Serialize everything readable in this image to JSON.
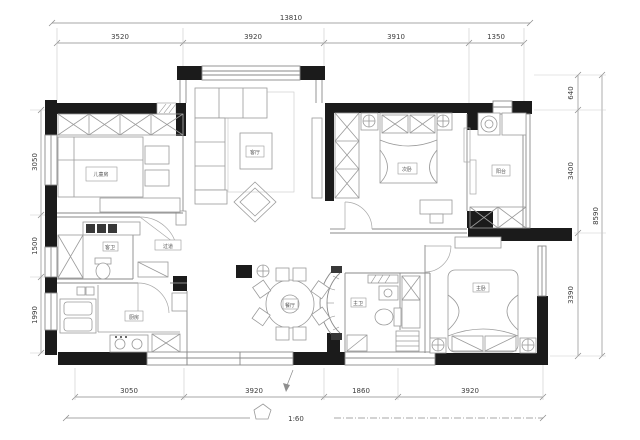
{
  "plan": {
    "scale_text": "1:60",
    "dims": {
      "top_total": "13810",
      "top": [
        "3520",
        "3920",
        "3910",
        "1350"
      ],
      "left": [
        "3050",
        "1500",
        "1990"
      ],
      "right_total": "8590",
      "right": [
        "640",
        "3400",
        "3390"
      ],
      "bottom": [
        "3050",
        "3920",
        "1860",
        "3920"
      ]
    },
    "rooms": {
      "study": "儿童房",
      "living": "客厅",
      "bedroom2": "次卧",
      "balcony": "阳台",
      "guest_bath": "客卫",
      "hall": "过道",
      "kitchen": "厨房",
      "dining": "餐厅",
      "master_bath": "主卫",
      "master": "主卧"
    },
    "colors": {
      "wall": "#1b1b1b",
      "line": "#8a8a8a",
      "dim_text": "#3d3d3d",
      "bg": "#ffffff"
    }
  }
}
